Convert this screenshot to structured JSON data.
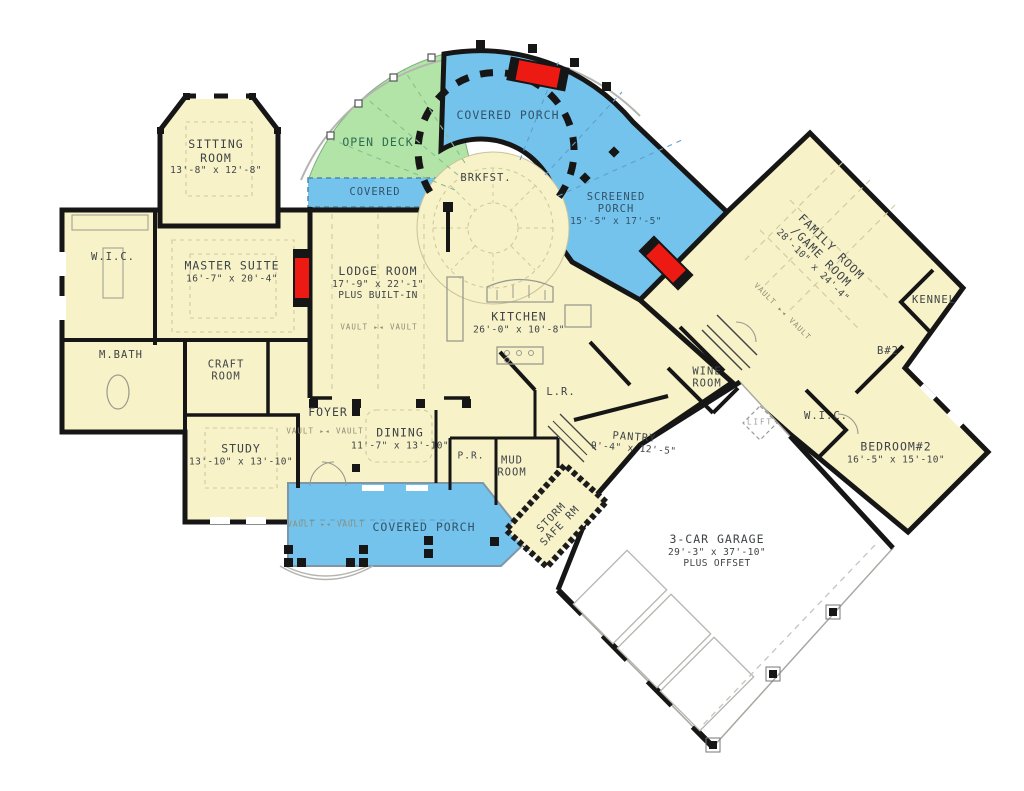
{
  "meta": {
    "title": "House floor plan drawing",
    "canvas_width": 1024,
    "canvas_height": 791
  },
  "colors": {
    "room_fill": "#f7f2c8",
    "porch_fill": "#74c3ec",
    "deck_fill": "#b2e4a8",
    "garage_fill": "#ffffff",
    "wall": "#161616",
    "fireplace": "#ec1a12",
    "detail_line": "#9a9a8e",
    "ceiling_line": "#cfc99e",
    "text": "#3f4447",
    "porch_text": "#32536b",
    "deck_text": "#2f6b4f",
    "muted_text": "#8e8c74"
  },
  "rooms": {
    "sitting": {
      "lines": [
        "SITTING",
        "ROOM",
        "13'-8\" x 12'-8\""
      ]
    },
    "open_deck": {
      "lines": [
        "OPEN DECK"
      ]
    },
    "covered_strip": {
      "lines": [
        "COVERED"
      ]
    },
    "covered_porch_top": {
      "lines": [
        "COVERED PORCH"
      ]
    },
    "brkfst": {
      "lines": [
        "BRKFST."
      ]
    },
    "screened_porch": {
      "lines": [
        "SCREENED",
        "PORCH",
        "15'-5\" x 17'-5\""
      ]
    },
    "family_room": {
      "lines": [
        "FAMILY ROOM",
        "/GAME ROOM",
        "28'-10\" x 24'-4\""
      ]
    },
    "kennel": {
      "lines": [
        "KENNEL"
      ]
    },
    "bath2": {
      "lines": [
        "B#2"
      ]
    },
    "wic_left": {
      "lines": [
        "W.I.C."
      ]
    },
    "master": {
      "lines": [
        "MASTER SUITE",
        "16'-7\" x 20'-4\""
      ]
    },
    "lodge": {
      "lines": [
        "LODGE ROOM",
        "17'-9\" x 22'-1\"",
        "PLUS BUILT-IN"
      ]
    },
    "kitchen": {
      "lines": [
        "KITCHEN",
        "26'-0\" x 10'-8\""
      ]
    },
    "mbath": {
      "lines": [
        "M.BATH"
      ]
    },
    "craft": {
      "lines": [
        "CRAFT",
        "ROOM"
      ]
    },
    "wine": {
      "lines": [
        "WINE",
        "ROOM"
      ]
    },
    "laundry": {
      "lines": [
        "L.R."
      ]
    },
    "foyer": {
      "lines": [
        "FOYER"
      ]
    },
    "dining": {
      "lines": [
        "DINING",
        "11'-7\" x 13'-10\""
      ]
    },
    "study": {
      "lines": [
        "STUDY",
        "13'-10\" x 13'-10\""
      ]
    },
    "powder": {
      "lines": [
        "P.R."
      ]
    },
    "mud": {
      "lines": [
        "MUD",
        "ROOM"
      ]
    },
    "pantry": {
      "lines": [
        "PANTRY",
        "9'-4\" x 12'-5\""
      ]
    },
    "storm": {
      "lines": [
        "STORM",
        "SAFE RM"
      ]
    },
    "garage": {
      "lines": [
        "3-CAR GARAGE",
        "29'-3\" x 37'-10\"",
        "PLUS OFFSET"
      ]
    },
    "lift": {
      "lines": [
        "LIFT"
      ]
    },
    "covered_porch_bottom": {
      "lines": [
        "COVERED PORCH"
      ]
    },
    "bedroom2": {
      "lines": [
        "BEDROOM#2",
        "16'-5\" x 15'-10\""
      ]
    },
    "wic_right": {
      "lines": [
        "W.I.C."
      ]
    }
  },
  "annotations": {
    "vault": "VAULT",
    "vault_marker": "▸◂"
  }
}
